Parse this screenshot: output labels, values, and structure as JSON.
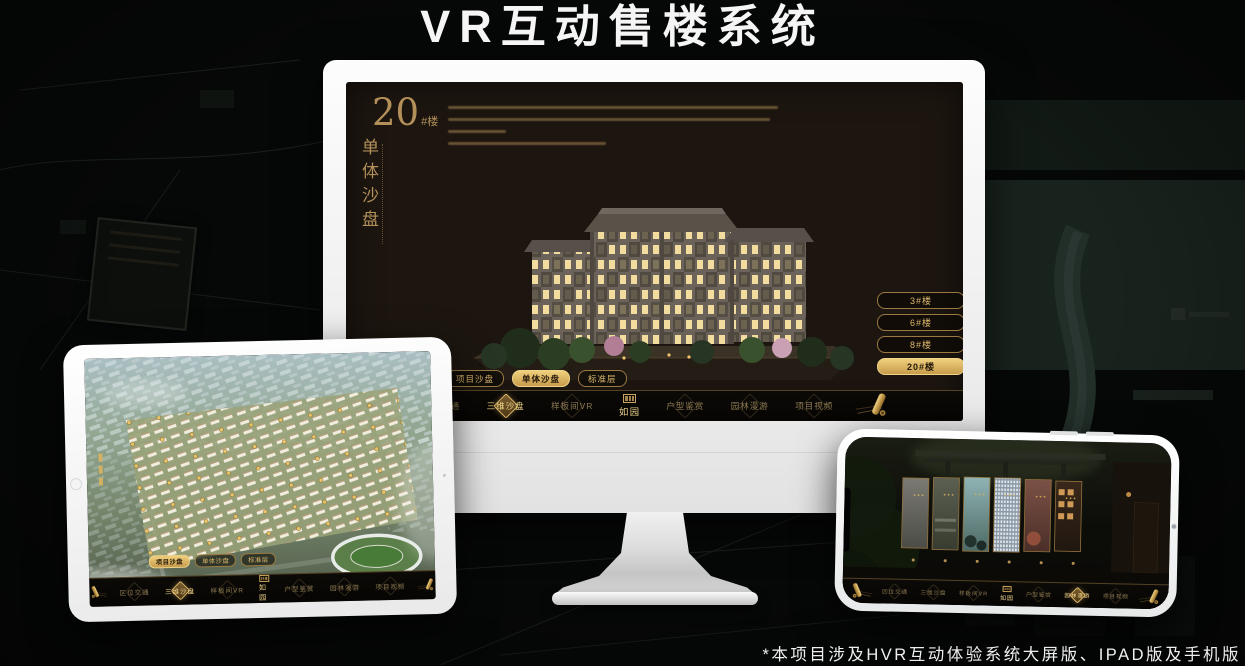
{
  "title": "VR互动售楼系统",
  "footnote": "*本项目涉及HVR互动体验系统大屏版、IPAD版及手机版",
  "colors": {
    "gold": "#c9a45c",
    "gold_bright": "#ecc979",
    "gold_deep": "#8a6a2c",
    "screen_bg": "#1d1610",
    "device_white": "#f4f4f4"
  },
  "sales_app": {
    "project_logo": "如园",
    "heading": {
      "number": "20",
      "suffix": "#楼",
      "subtitle": "单体沙盘"
    },
    "building_buttons": [
      {
        "label": "3#楼"
      },
      {
        "label": "6#楼"
      },
      {
        "label": "8#楼"
      },
      {
        "label": "20#楼"
      }
    ],
    "active_building": "20#楼",
    "view_tabs": [
      {
        "label": "项目沙盘"
      },
      {
        "label": "单体沙盘"
      },
      {
        "label": "标准层"
      }
    ],
    "monitor_active_tab": "单体沙盘",
    "tablet_active_tab": "项目沙盘",
    "nav_items": [
      {
        "label": "区位交通"
      },
      {
        "label": "三维沙盘"
      },
      {
        "label": "样板间VR"
      },
      {
        "label": "户型鉴赏"
      },
      {
        "label": "园林漫游"
      },
      {
        "label": "项目视频"
      }
    ],
    "monitor_active_nav": "三维沙盘",
    "tablet_active_nav": "三维沙盘",
    "phone_active_nav": "园林漫游"
  }
}
